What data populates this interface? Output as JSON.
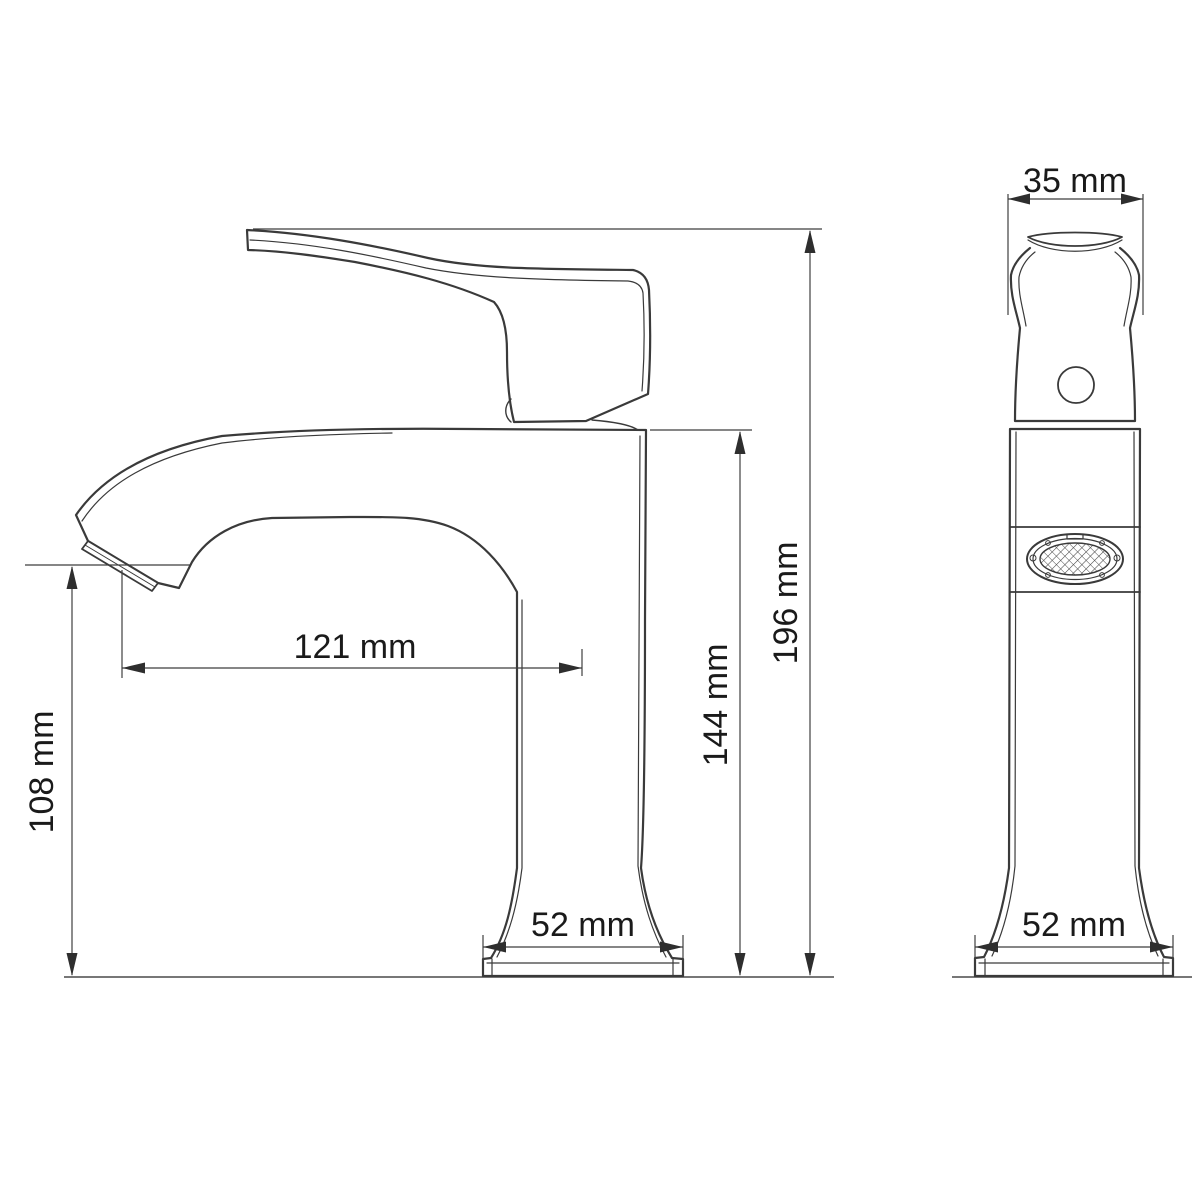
{
  "dimensions": {
    "handle_width_front": "35 mm",
    "overall_height": "196 mm",
    "spout_top_height": "144 mm",
    "spout_reach": "121 mm",
    "outlet_height": "108 mm",
    "base_width_side": "52 mm",
    "base_width_front": "52 mm"
  },
  "colors": {
    "background": "#ffffff",
    "line": "#3a3a3a",
    "text": "#1a1a1a"
  }
}
